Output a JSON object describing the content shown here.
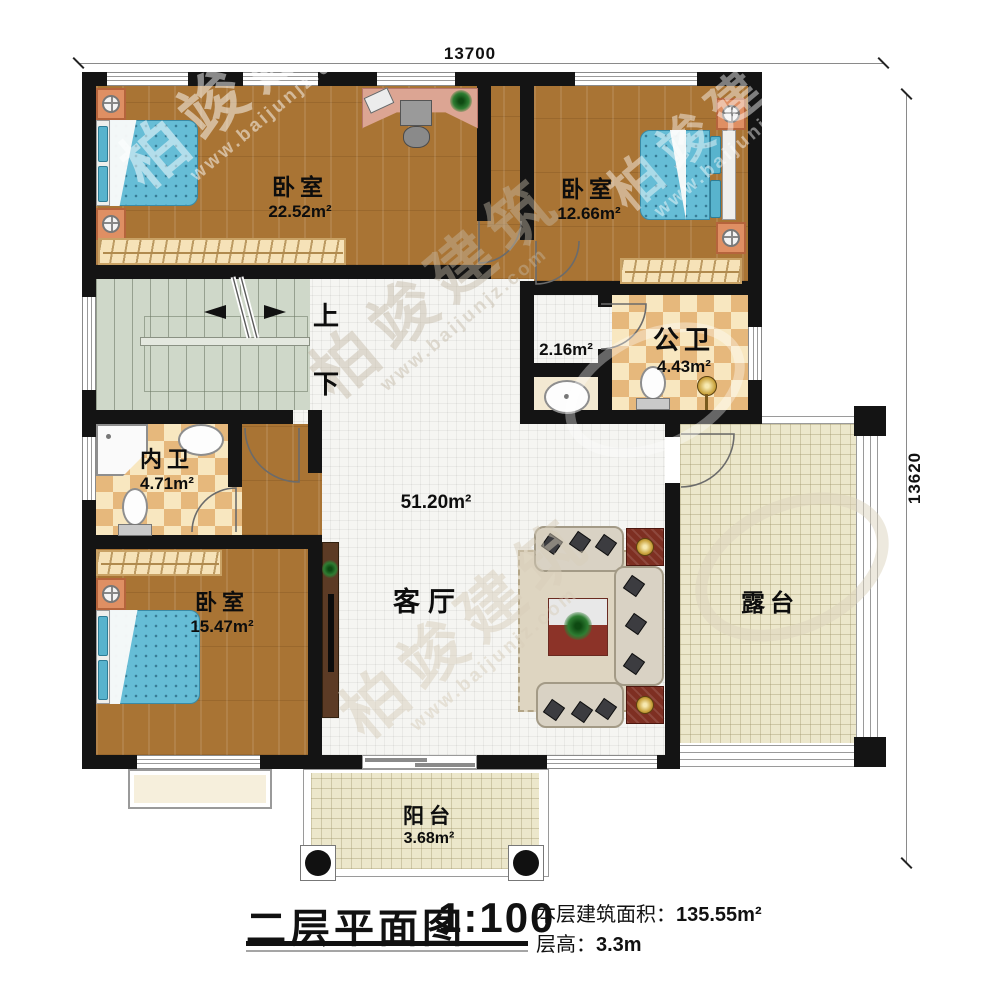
{
  "dimensions": {
    "top": "13700",
    "right": "13620"
  },
  "stairs": {
    "up": "上",
    "down": "下"
  },
  "rooms": {
    "bedroom1": {
      "name": "卧室",
      "area": "22.52m²"
    },
    "bedroom2": {
      "name": "卧室",
      "area": "12.66m²"
    },
    "bath_public": {
      "name": "公卫",
      "area": "4.43m²"
    },
    "wash": {
      "area": "2.16m²"
    },
    "bath_private": {
      "name": "内卫",
      "area": "4.71m²"
    },
    "bedroom3": {
      "name": "卧室",
      "area": "15.47m²"
    },
    "living": {
      "name": "客厅",
      "area": "51.20m²"
    },
    "terrace": {
      "name": "露台"
    },
    "balcony": {
      "name": "阳台",
      "area": "3.68m²"
    }
  },
  "title_block": {
    "title": "二层平面图",
    "scale": "1:100",
    "area_label": "本层建筑面积：",
    "area_value": "135.55m²",
    "floor_height_label": "层高：",
    "floor_height_value": "3.3m"
  },
  "watermark": {
    "brand": "柏竣建筑",
    "site": "www.baijunjz.com"
  },
  "colors": {
    "wall": "#141414",
    "wood_floor": "#a97434",
    "bath_tile": "#e6b87c",
    "stair_floor": "#cfd8c9",
    "hall_tile": "#f5f5f2",
    "terrace_floor": "#ece7cb",
    "bed": "#66bdd6",
    "accent_red": "#7e2f22"
  }
}
